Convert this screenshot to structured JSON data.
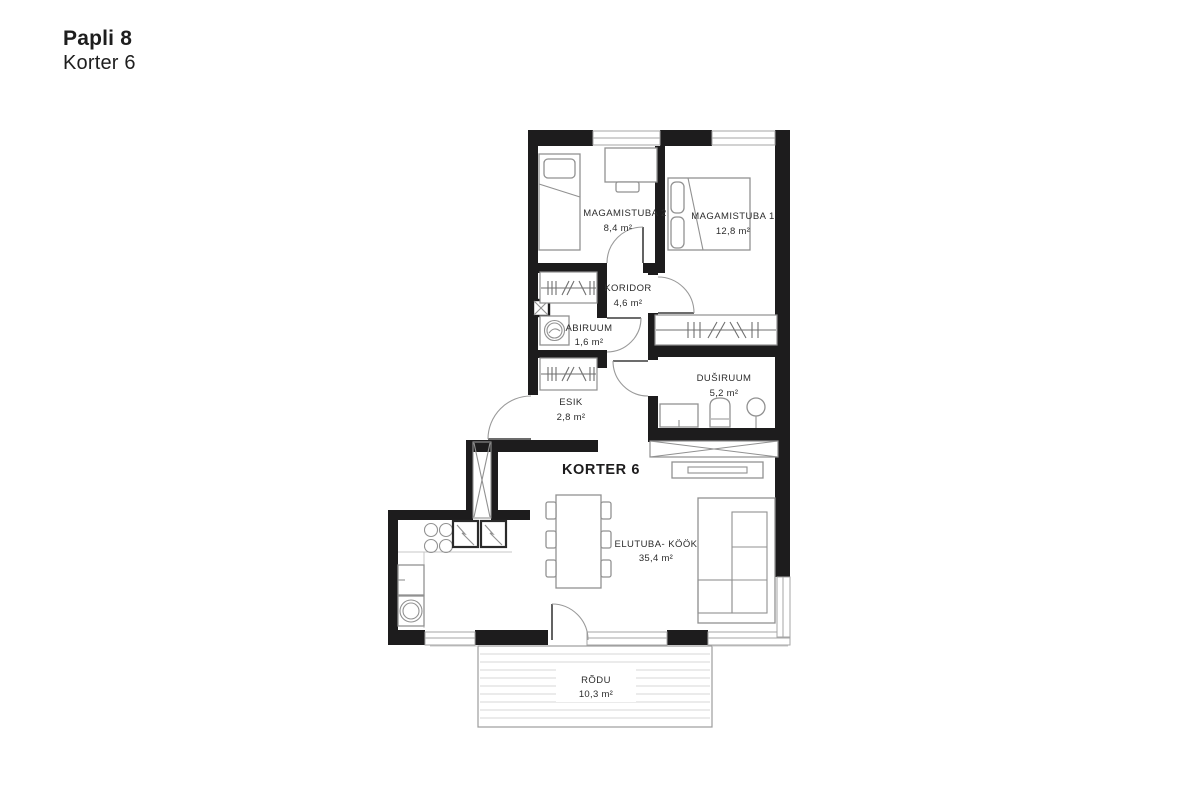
{
  "header": {
    "project": "Papli 8",
    "unit": "Korter 6"
  },
  "plan": {
    "apartment_label": "KORTER 6",
    "rooms": [
      {
        "name": "MAGAMISTUBA 2",
        "area": "8,4 m²"
      },
      {
        "name": "MAGAMISTUBA 1",
        "area": "12,8 m²"
      },
      {
        "name": "KORIDOR",
        "area": "4,6 m²"
      },
      {
        "name": "ABIRUUM",
        "area": "1,6 m²"
      },
      {
        "name": "DUŠIRUUM",
        "area": "5,2 m²"
      },
      {
        "name": "ESIK",
        "area": "2,8 m²"
      },
      {
        "name": "ELUTUBA- KÖÖK",
        "area": "35,4 m²"
      },
      {
        "name": "RÕDU",
        "area": "10,3 m²"
      }
    ],
    "colors": {
      "wall": "#1d1c1d",
      "furniture": "#919191",
      "window": "#a6a6a6",
      "text": "#2c2c2c"
    }
  }
}
